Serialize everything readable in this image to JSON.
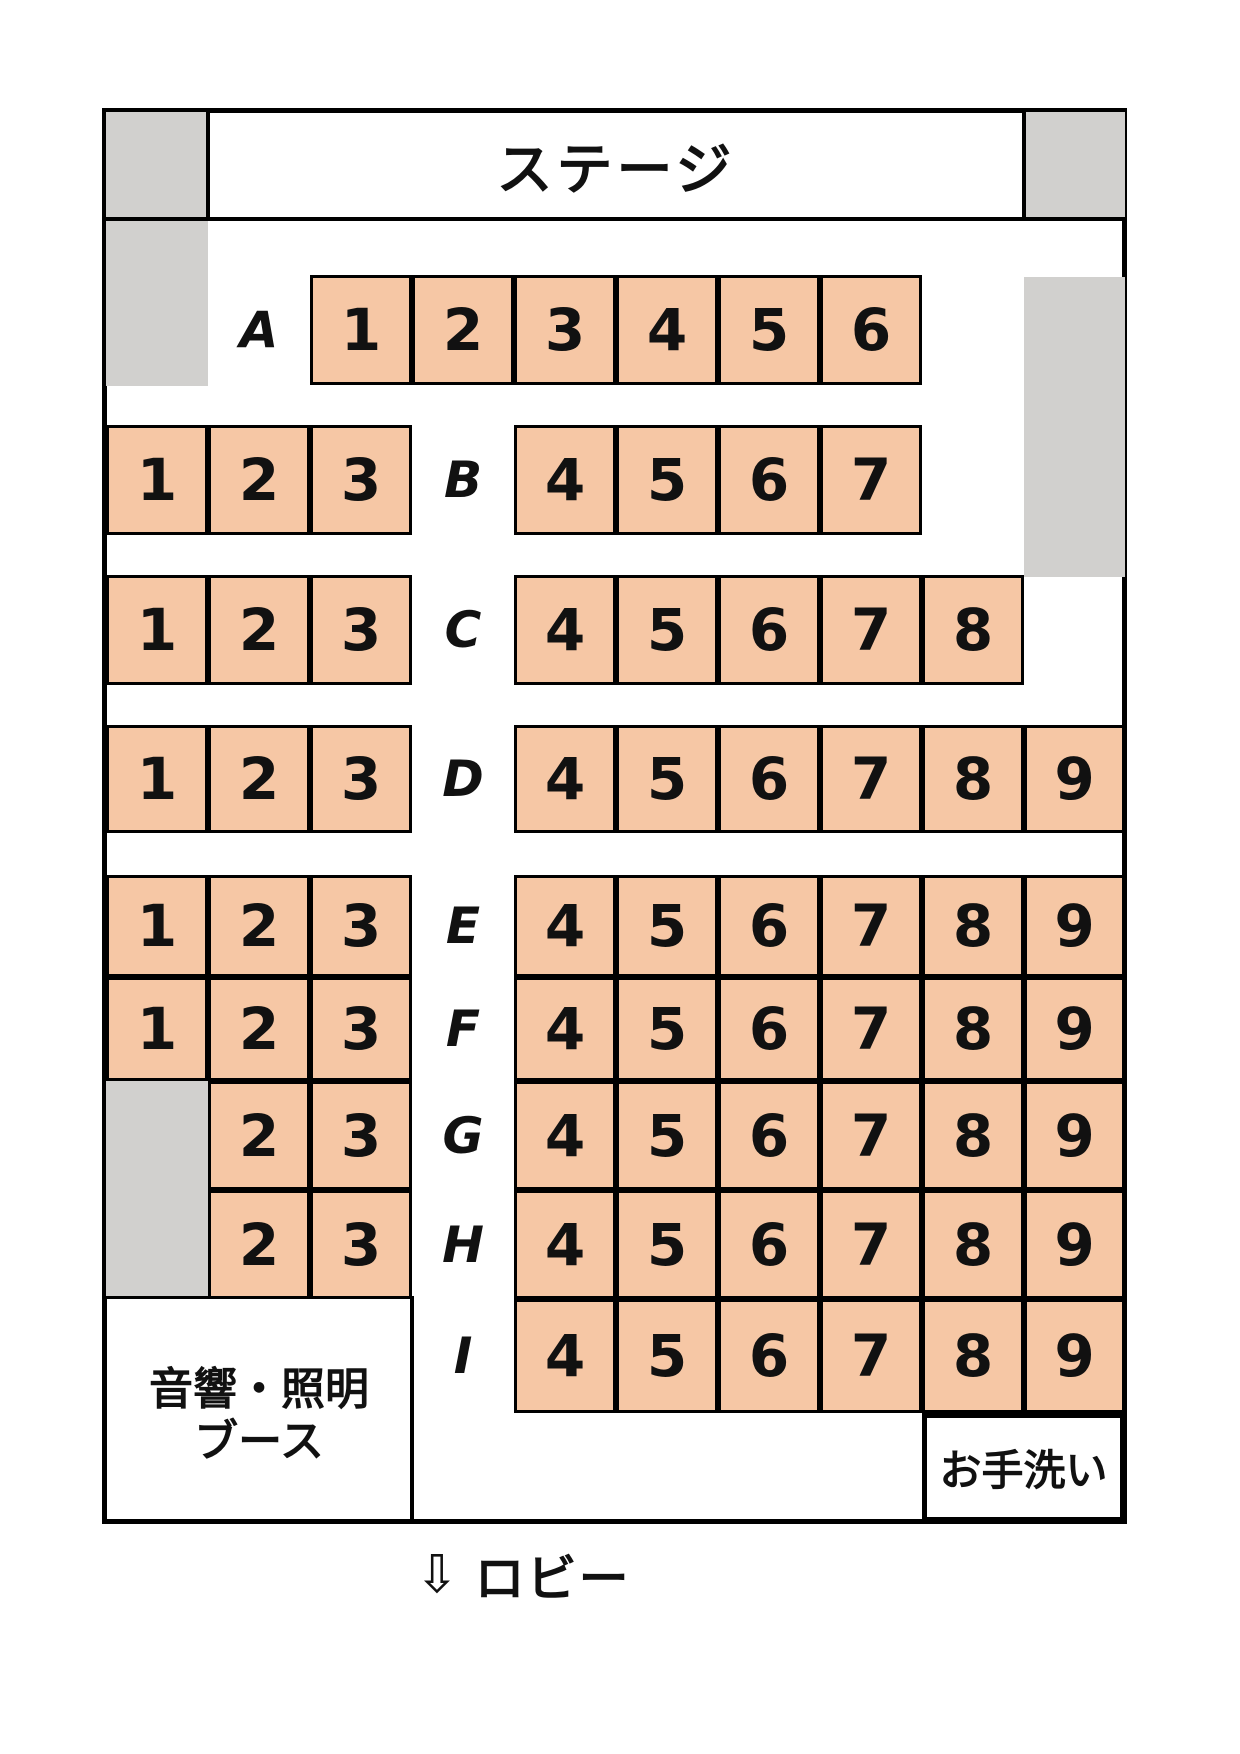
{
  "stage": {
    "label": "ステージ"
  },
  "booth": {
    "line1": "音響・照明",
    "line2": "ブース"
  },
  "restroom": {
    "label": "お手洗い"
  },
  "lobby": {
    "arrow": "⇩",
    "label": "ロビー"
  },
  "colors": {
    "seat_fill": "#f6c7a5",
    "blocked_gray": "#d1d0ce",
    "line": "#000000",
    "background": "#ffffff"
  },
  "rows": [
    {
      "label": "A",
      "seats": [
        {
          "num": "1",
          "col": 2
        },
        {
          "num": "2",
          "col": 3
        },
        {
          "num": "3",
          "col": 4
        },
        {
          "num": "4",
          "col": 5
        },
        {
          "num": "5",
          "col": 6
        },
        {
          "num": "6",
          "col": 7
        }
      ]
    },
    {
      "label": "B",
      "seats": [
        {
          "num": "1",
          "col": 0
        },
        {
          "num": "2",
          "col": 1
        },
        {
          "num": "3",
          "col": 2
        },
        {
          "num": "4",
          "col": 4
        },
        {
          "num": "5",
          "col": 5
        },
        {
          "num": "6",
          "col": 6
        },
        {
          "num": "7",
          "col": 7
        }
      ]
    },
    {
      "label": "C",
      "seats": [
        {
          "num": "1",
          "col": 0
        },
        {
          "num": "2",
          "col": 1
        },
        {
          "num": "3",
          "col": 2
        },
        {
          "num": "4",
          "col": 4
        },
        {
          "num": "5",
          "col": 5
        },
        {
          "num": "6",
          "col": 6
        },
        {
          "num": "7",
          "col": 7
        },
        {
          "num": "8",
          "col": 8
        }
      ]
    },
    {
      "label": "D",
      "seats": [
        {
          "num": "1",
          "col": 0
        },
        {
          "num": "2",
          "col": 1
        },
        {
          "num": "3",
          "col": 2
        },
        {
          "num": "4",
          "col": 4
        },
        {
          "num": "5",
          "col": 5
        },
        {
          "num": "6",
          "col": 6
        },
        {
          "num": "7",
          "col": 7
        },
        {
          "num": "8",
          "col": 8
        },
        {
          "num": "9",
          "col": 9
        }
      ]
    },
    {
      "label": "E",
      "seats": [
        {
          "num": "1",
          "col": 0
        },
        {
          "num": "2",
          "col": 1
        },
        {
          "num": "3",
          "col": 2
        },
        {
          "num": "4",
          "col": 4
        },
        {
          "num": "5",
          "col": 5
        },
        {
          "num": "6",
          "col": 6
        },
        {
          "num": "7",
          "col": 7
        },
        {
          "num": "8",
          "col": 8
        },
        {
          "num": "9",
          "col": 9
        }
      ]
    },
    {
      "label": "F",
      "seats": [
        {
          "num": "1",
          "col": 0
        },
        {
          "num": "2",
          "col": 1
        },
        {
          "num": "3",
          "col": 2
        },
        {
          "num": "4",
          "col": 4
        },
        {
          "num": "5",
          "col": 5
        },
        {
          "num": "6",
          "col": 6
        },
        {
          "num": "7",
          "col": 7
        },
        {
          "num": "8",
          "col": 8
        },
        {
          "num": "9",
          "col": 9
        }
      ]
    },
    {
      "label": "G",
      "seats": [
        {
          "num": "2",
          "col": 1
        },
        {
          "num": "3",
          "col": 2
        },
        {
          "num": "4",
          "col": 4
        },
        {
          "num": "5",
          "col": 5
        },
        {
          "num": "6",
          "col": 6
        },
        {
          "num": "7",
          "col": 7
        },
        {
          "num": "8",
          "col": 8
        },
        {
          "num": "9",
          "col": 9
        }
      ]
    },
    {
      "label": "H",
      "seats": [
        {
          "num": "2",
          "col": 1
        },
        {
          "num": "3",
          "col": 2
        },
        {
          "num": "4",
          "col": 4
        },
        {
          "num": "5",
          "col": 5
        },
        {
          "num": "6",
          "col": 6
        },
        {
          "num": "7",
          "col": 7
        },
        {
          "num": "8",
          "col": 8
        },
        {
          "num": "9",
          "col": 9
        }
      ]
    },
    {
      "label": "I",
      "seats": [
        {
          "num": "4",
          "col": 4
        },
        {
          "num": "5",
          "col": 5
        },
        {
          "num": "6",
          "col": 6
        },
        {
          "num": "7",
          "col": 7
        },
        {
          "num": "8",
          "col": 8
        },
        {
          "num": "9",
          "col": 9
        }
      ]
    }
  ]
}
